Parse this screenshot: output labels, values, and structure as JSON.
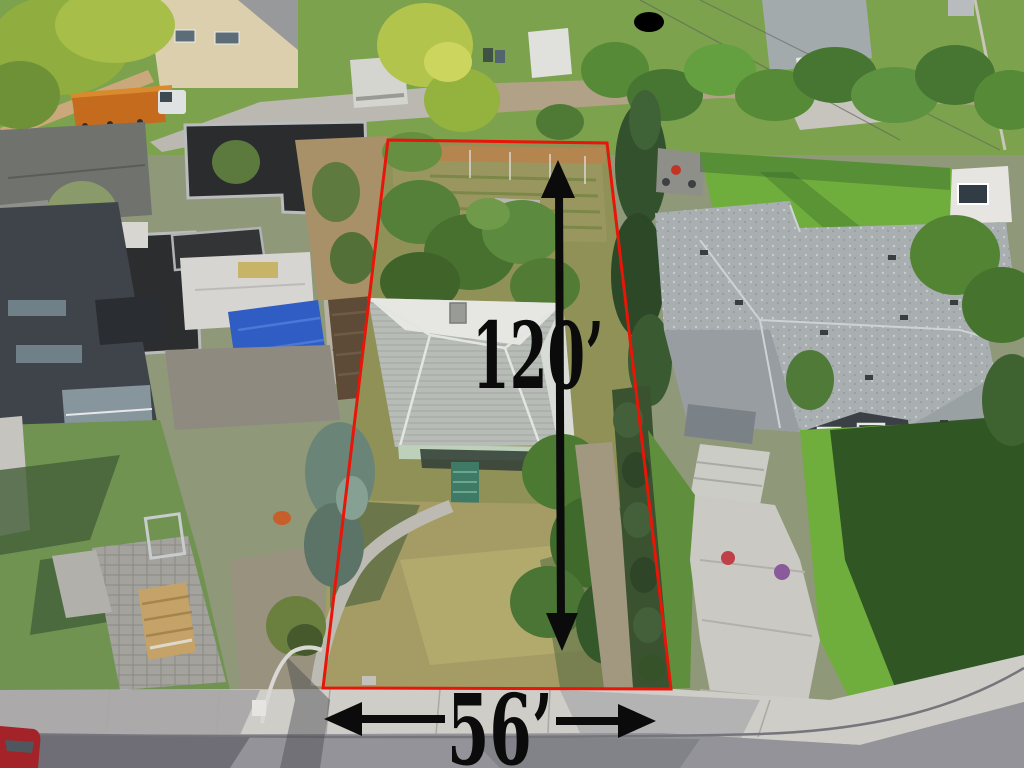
{
  "annotations": {
    "depth_label": "120’",
    "width_label": "56’",
    "boundary_color": "#e81508",
    "arrow_color": "#0b0b0b",
    "text_color": "#0b0b0b"
  },
  "palette": {
    "subject_roof_white": "#e6e7e3",
    "subject_roof_shingle": "#b7bcb7",
    "neighbor_roof_gray": "#a9afb1",
    "lawn_bright": "#6fae3c",
    "lawn_shadow": "#24471f",
    "front_lawn_dry": "#a49c64",
    "street_asphalt": "#94939a",
    "sidewalk_concrete": "#cecdc8",
    "construction_roof_black": "#2b2d2f",
    "tarp_blue": "#2f5dc4",
    "crane_orange": "#c56b1e",
    "car_red": "#a32329",
    "entry_steps_teal": "#3e7a66",
    "alley_gravel": "#b1a287"
  }
}
